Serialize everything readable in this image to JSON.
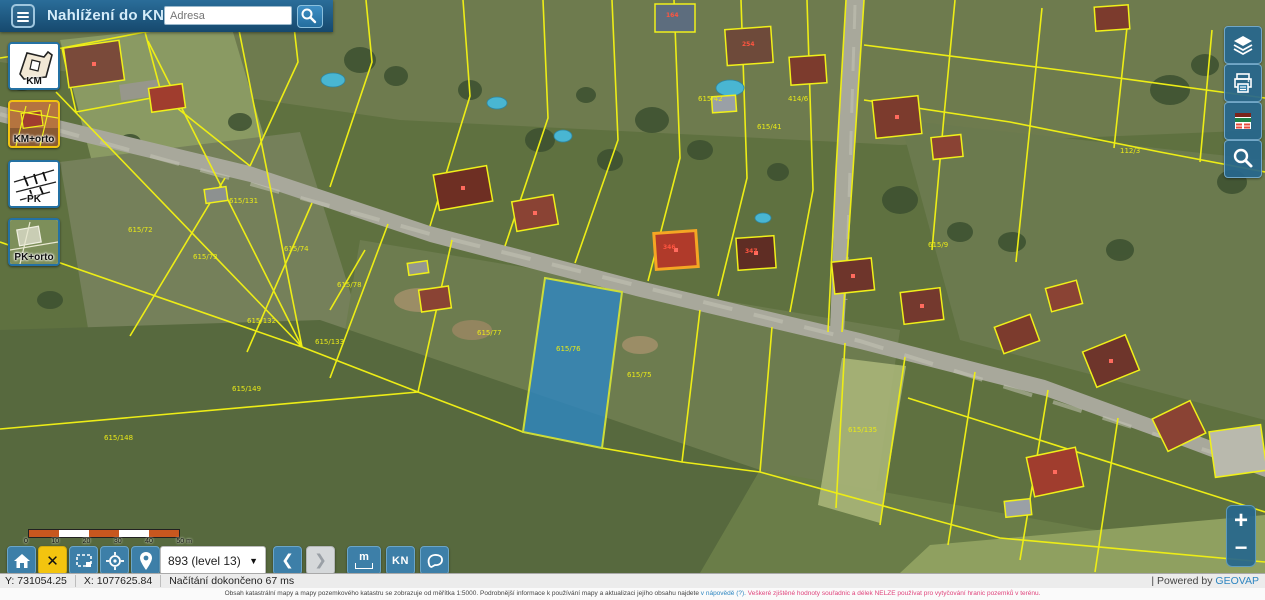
{
  "header": {
    "title": "Nahlížení do KN",
    "search_placeholder": "Adresa"
  },
  "layer_panel": {
    "buttons": [
      {
        "label": "KM",
        "selected": false
      },
      {
        "label": "KM+orto",
        "selected": true
      },
      {
        "label": "PK",
        "selected": false
      },
      {
        "label": "PK+orto",
        "selected": false
      }
    ]
  },
  "right_toolbar": {
    "icons": [
      "layers",
      "print",
      "legend",
      "search"
    ]
  },
  "scalebar": {
    "ticks": [
      "0",
      "10",
      "20",
      "30",
      "40",
      "50"
    ],
    "unit": "m"
  },
  "toolbar": {
    "zoom_value": "893 (level 13)",
    "back": "❮",
    "forward": "❯",
    "close": "✕",
    "measure_label": "m",
    "kn_label": "KN"
  },
  "zoom_control": {
    "plus": "+",
    "minus": "−"
  },
  "statusbar": {
    "y": "Y: 731054.25",
    "x": "X: 1077625.84",
    "status": "Načítání dokončeno 67 ms",
    "powered_prefix": "| Powered by ",
    "brand": "GEOVAP"
  },
  "disclaimer": {
    "part1": "Obsah katastrální mapy a mapy pozemkového katastru se zobrazuje od měřítka 1:5000. Podrobnější informace k používání mapy a aktualizaci jejího obsahu najdete ",
    "part2": "v nápovědě (?). ",
    "part3": "Veškeré zjištěné hodnoty souřadnic a délek NELZE používat pro vytyčování hranic pozemků v terénu."
  },
  "map": {
    "selected_parcel": "615/76",
    "colors": {
      "parcel_line": "#eded16",
      "selection_fill": "#2e86c1",
      "selection_outline": "#cddc39",
      "road": "#a8a89b"
    },
    "parcel_labels": [
      {
        "text": "615/72"
      },
      {
        "text": "615/73"
      },
      {
        "text": "615/74"
      },
      {
        "text": "615/131"
      },
      {
        "text": "615/132"
      },
      {
        "text": "615/133"
      },
      {
        "text": "615/77"
      },
      {
        "text": "615/76"
      },
      {
        "text": "615/75"
      },
      {
        "text": "615/78"
      },
      {
        "text": "615/148"
      },
      {
        "text": "615/149"
      },
      {
        "text": "414/6"
      },
      {
        "text": "112/3"
      },
      {
        "text": "615/135"
      },
      {
        "text": "615/42"
      },
      {
        "text": "615/41"
      },
      {
        "text": "615/9"
      }
    ],
    "house_labels": [
      {
        "text": "347"
      },
      {
        "text": "346"
      },
      {
        "text": "164"
      },
      {
        "text": "254"
      }
    ]
  }
}
